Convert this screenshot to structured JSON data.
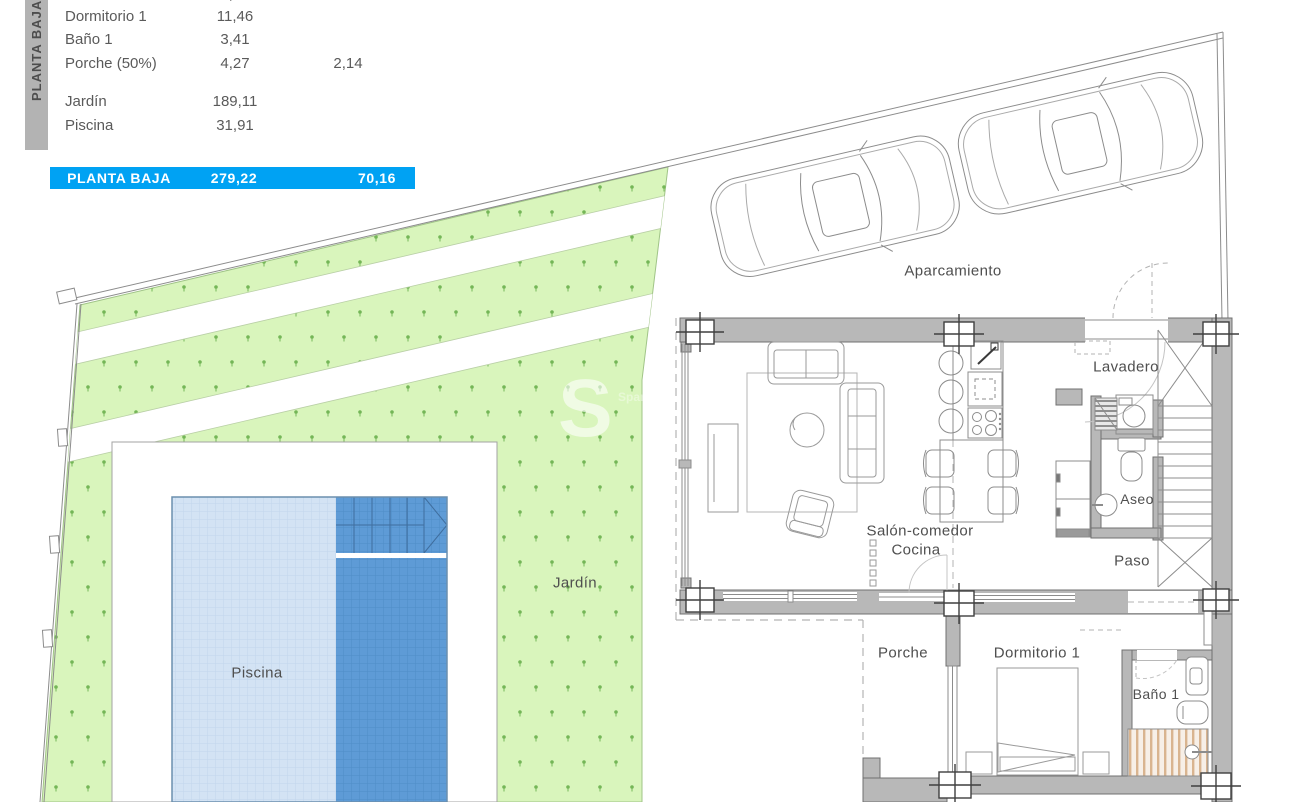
{
  "title": "Planta Baja - plano de vivienda",
  "summary_table": {
    "sidebar_label": "PLANTA BAJA",
    "columns": [
      "Estancia",
      "m2",
      "m2 (50%)"
    ],
    "rows": [
      {
        "label": "Aseo",
        "m2": "1,50",
        "m2_secondary": "",
        "note": "partially cut off at top edge"
      },
      {
        "label": "Dormitorio 1",
        "m2": "11,46",
        "m2_secondary": ""
      },
      {
        "label": "Baño 1",
        "m2": "3,41",
        "m2_secondary": ""
      },
      {
        "label": "Porche (50%)",
        "m2": "4,27",
        "m2_secondary": "2,14"
      },
      {
        "label": "Jardín",
        "m2": "189,11",
        "m2_secondary": ""
      },
      {
        "label": "Piscina",
        "m2": "31,91",
        "m2_secondary": ""
      }
    ],
    "total_row": {
      "label": "PLANTA BAJA",
      "m2": "279,22",
      "m2_secondary": "70,16"
    }
  },
  "plan_labels": {
    "aparcamiento": "Aparcamiento",
    "lavadero": "Lavadero",
    "salon_comedor": "Salón-comedor",
    "cocina": "Cocina",
    "aseo": "Aseo",
    "paso": "Paso",
    "porche": "Porche",
    "dormitorio1": "Dormitorio 1",
    "bano1": "Baño 1",
    "jardin": "Jardín",
    "piscina": "Piscina"
  },
  "watermark": {
    "letter": "S",
    "side_text": "Span"
  },
  "colors": {
    "accent_blue_row": "#00a2f3",
    "sidebar_gray": "#b3b3b3",
    "garden_green": "#d9f5bc",
    "garden_dot_green": "#7cbb5e",
    "pool_light_blue": "#d3e3f4",
    "pool_dark_blue": "#5e9bd6",
    "wall_gray": "#b8b8b8",
    "shower_tan": "#d9b48f",
    "text_gray": "#4f4f4f"
  }
}
